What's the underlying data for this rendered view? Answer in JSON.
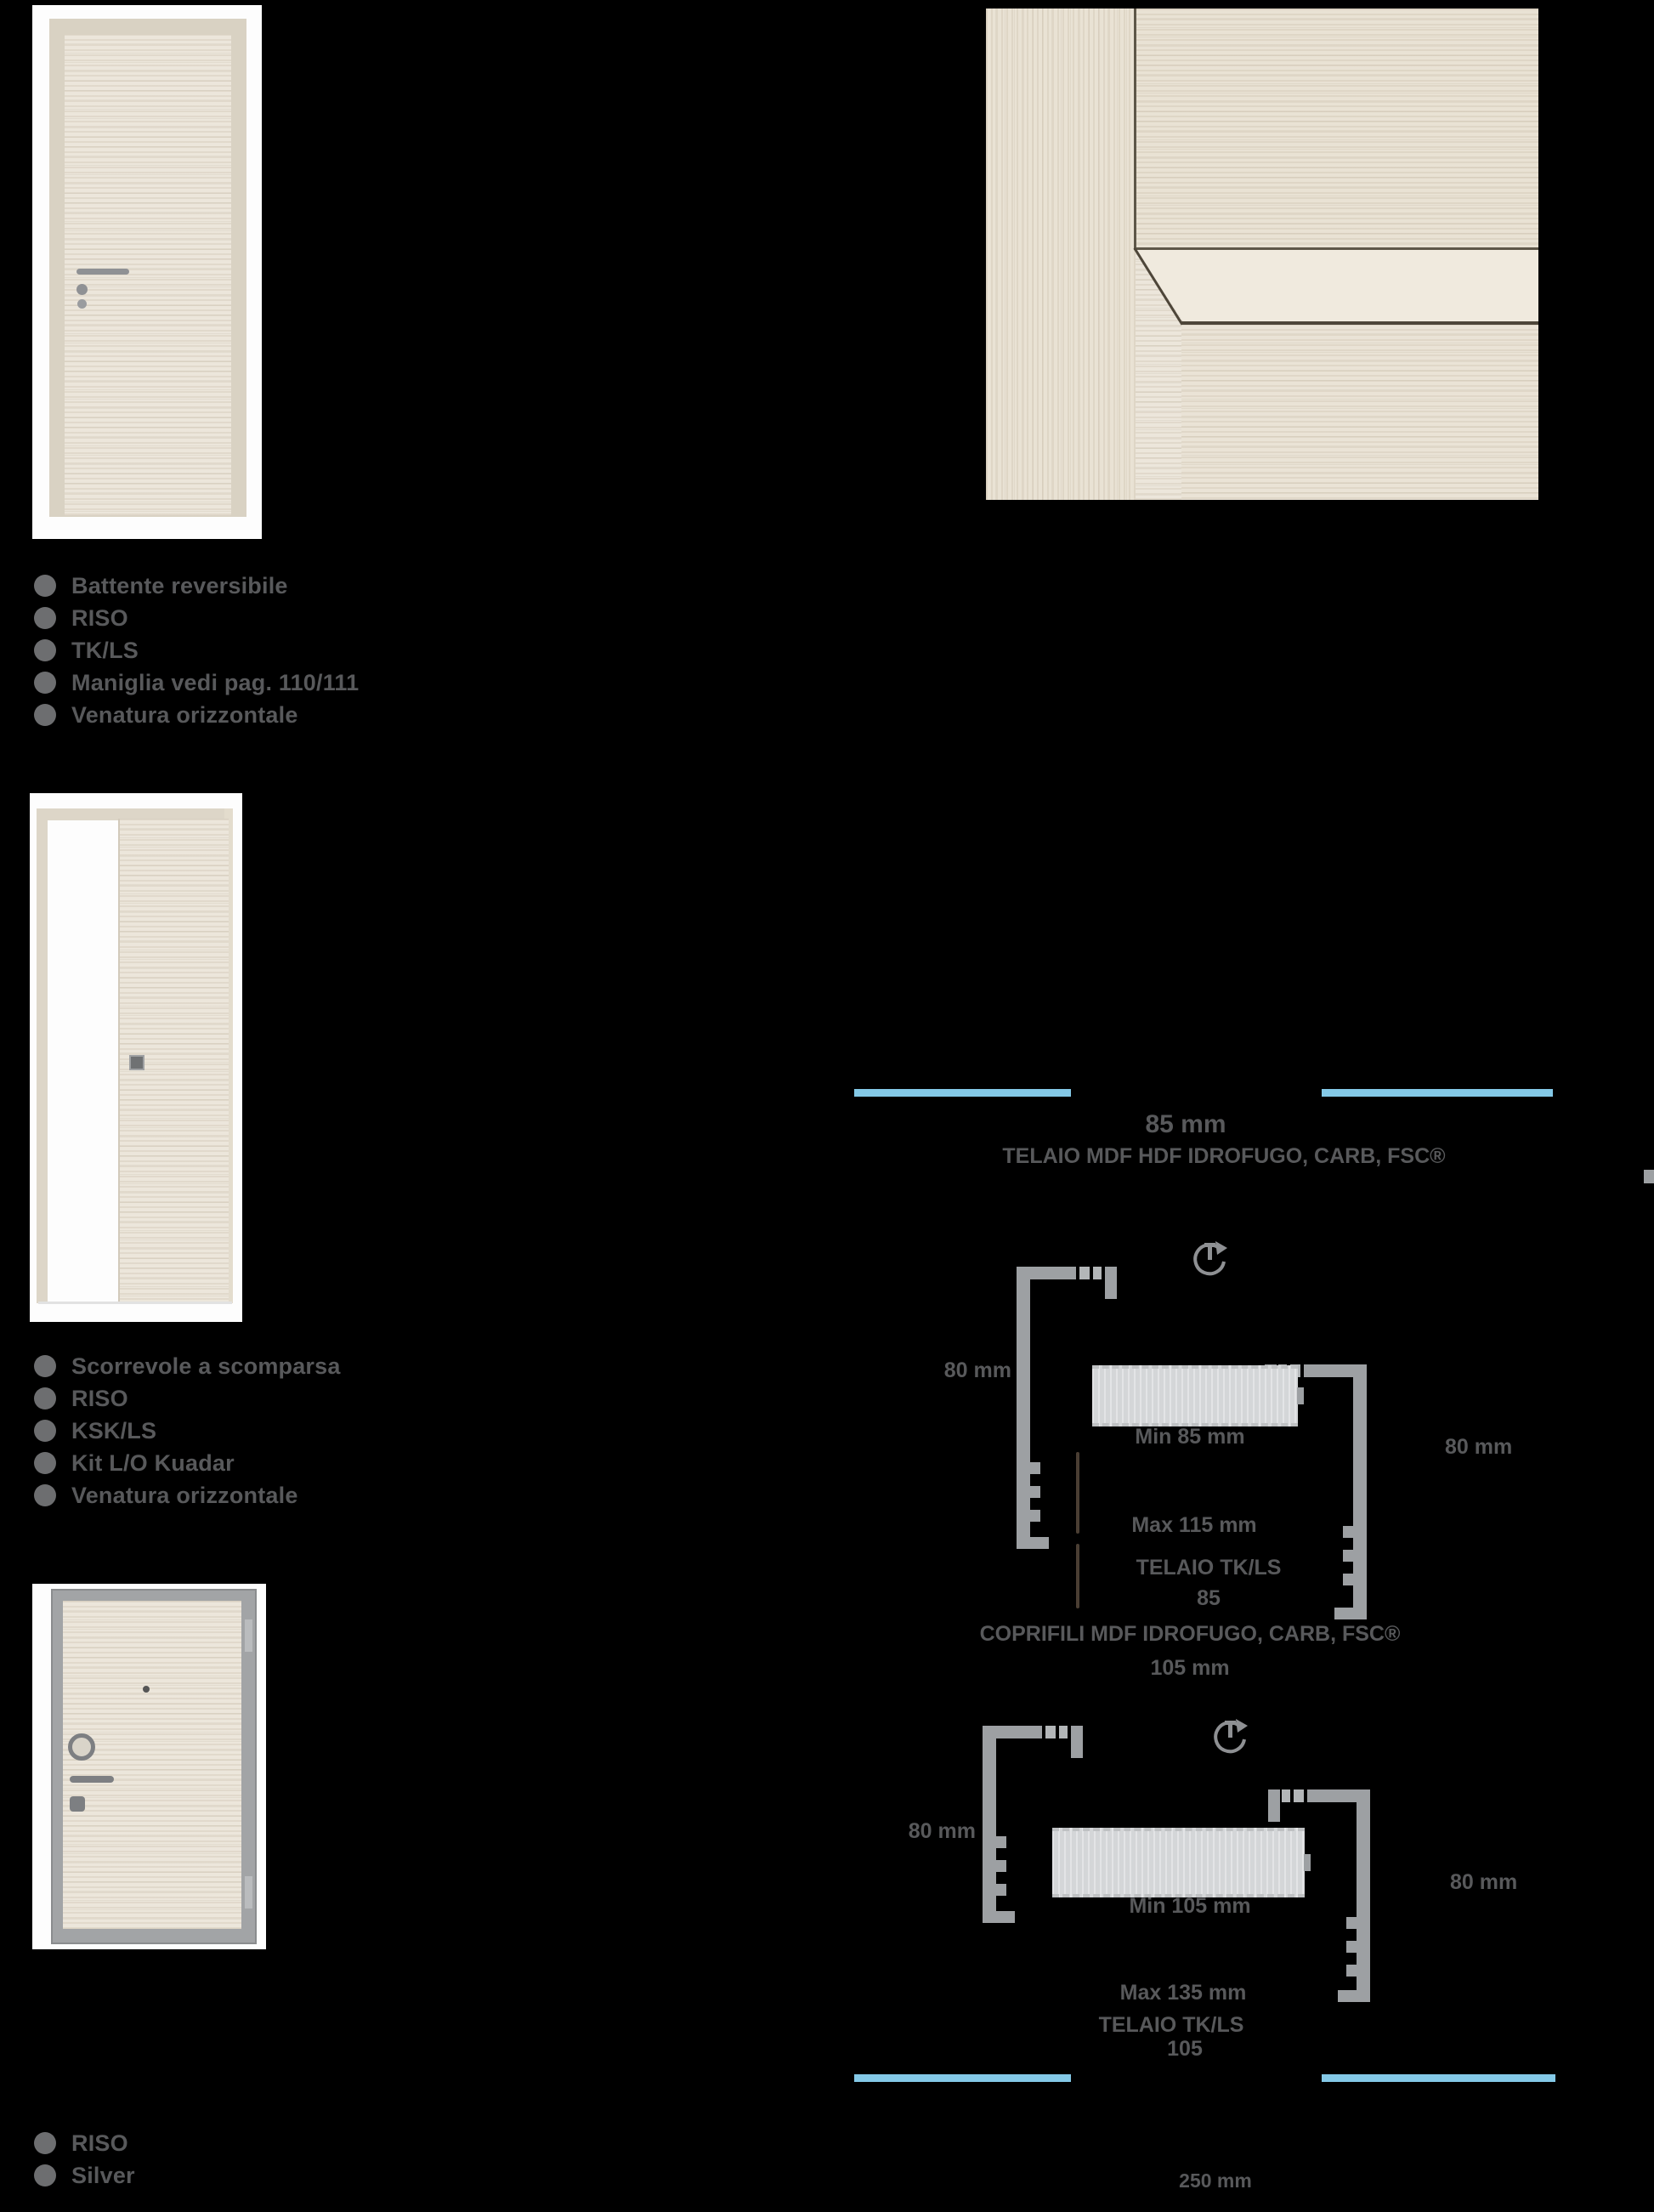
{
  "page": {
    "background": "#000000"
  },
  "products": [
    {
      "name": "hinged-door",
      "features": [
        "Battente reversibile",
        "RISO",
        "TK/LS",
        "Maniglia vedi pag. 110/111",
        "Venatura orizzontale"
      ]
    },
    {
      "name": "pocket-sliding-door",
      "features": [
        "Scorrevole a scomparsa",
        "RISO",
        "KSK/LS",
        "Kit L/O Kuadar",
        "Venatura orizzontale"
      ]
    },
    {
      "name": "security-door",
      "features": [
        "RISO",
        "Silver"
      ]
    }
  ],
  "tech": {
    "top_size": "85 mm",
    "frame_material": "TELAIO MDF HDF IDROFUGO, CARB, FSC®",
    "diagram_85": {
      "left_dim": "80 mm",
      "right_dim": "80 mm",
      "wall_min": "Min 85 mm",
      "wall_max": "Max 115 mm",
      "frame_name": "TELAIO TK/LS",
      "frame_size": "85"
    },
    "coprifili_material": "COPRIFILI MDF IDROFUGO, CARB, FSC®",
    "coprifili_size": "105 mm",
    "diagram_105": {
      "left_dim": "80 mm",
      "right_dim": "80 mm",
      "wall_min": "Min 105 mm",
      "wall_max": "Max 135 mm",
      "frame_name": "TELAIO TK/LS",
      "frame_size": "105"
    },
    "bottom_size": "250 mm",
    "accent_color": "#84c9e7",
    "text_color": "#58595b"
  }
}
